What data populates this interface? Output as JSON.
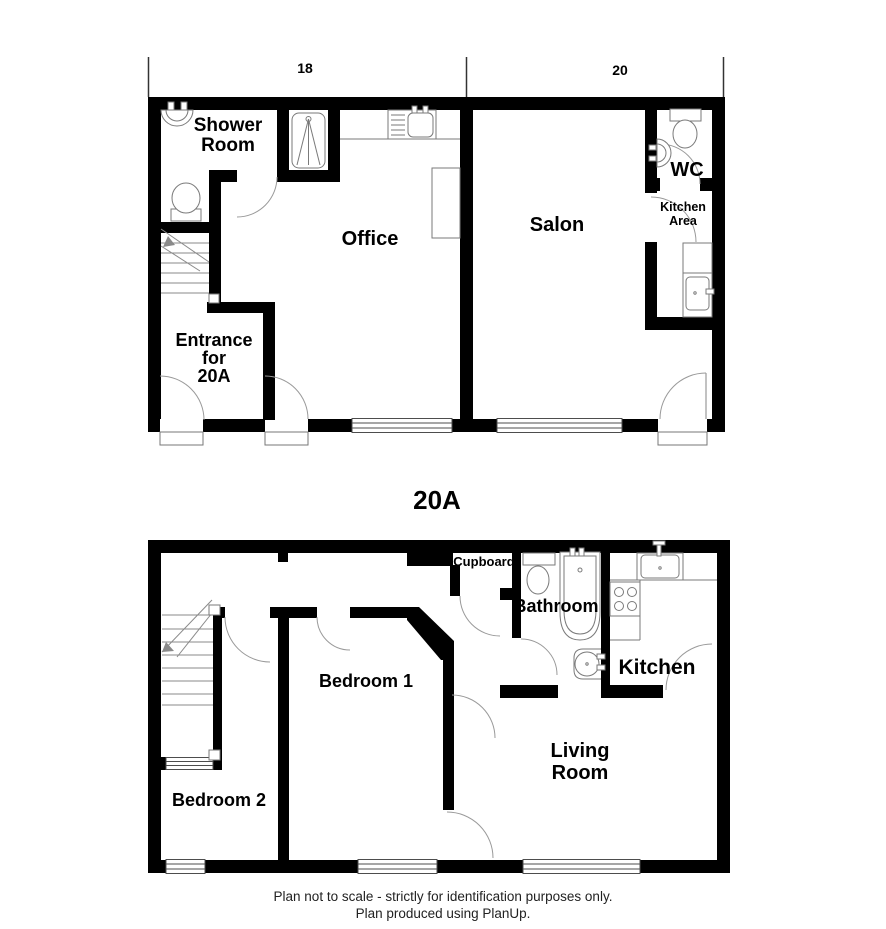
{
  "upper_plan": {
    "dim_left": "18",
    "dim_right": "20",
    "shower_room": [
      "Shower",
      "Room"
    ],
    "office": "Office",
    "salon": "Salon",
    "wc": "WC",
    "kitchen_area": [
      "Kitchen",
      "Area"
    ],
    "entrance": [
      "Entrance",
      "for",
      "20A"
    ]
  },
  "lower_plan": {
    "title": "20A",
    "cupboard": "Cupboard",
    "bathroom": "Bathroom",
    "kitchen": "Kitchen",
    "living_room": [
      "Living",
      "Room"
    ],
    "bedroom_1": "Bedroom 1",
    "bedroom_2": "Bedroom 2"
  },
  "footer": {
    "line1": "Plan not to scale - strictly for identification purposes only.",
    "line2": "Plan produced using PlanUp."
  },
  "colors": {
    "wall": "#000000",
    "fixture_outline": "#7a7a7a",
    "door_arc": "#9a9a9a",
    "text": "#000000"
  }
}
